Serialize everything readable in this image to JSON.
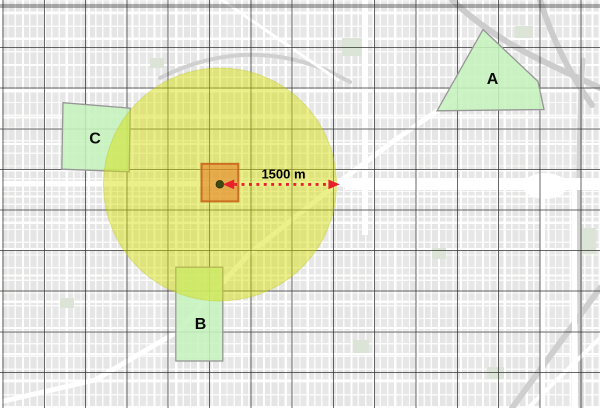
{
  "map": {
    "zone_labels": {
      "a": "A",
      "b": "B",
      "c": "C"
    },
    "buffer": {
      "distance_label": "1500 m"
    },
    "colors": {
      "basemap_background": "#e7e7e7",
      "graticule": "#2d2d2d",
      "zone_fill": "#c9f3c2",
      "zone_outline": "#969696",
      "buffer_fill": "#d5de00",
      "impact_square_fill": "#e67e22",
      "impact_square_outline": "#c8651a",
      "center_marker": "#3f4a10",
      "arrow": "#e8202c",
      "label_text": "#000000"
    }
  }
}
